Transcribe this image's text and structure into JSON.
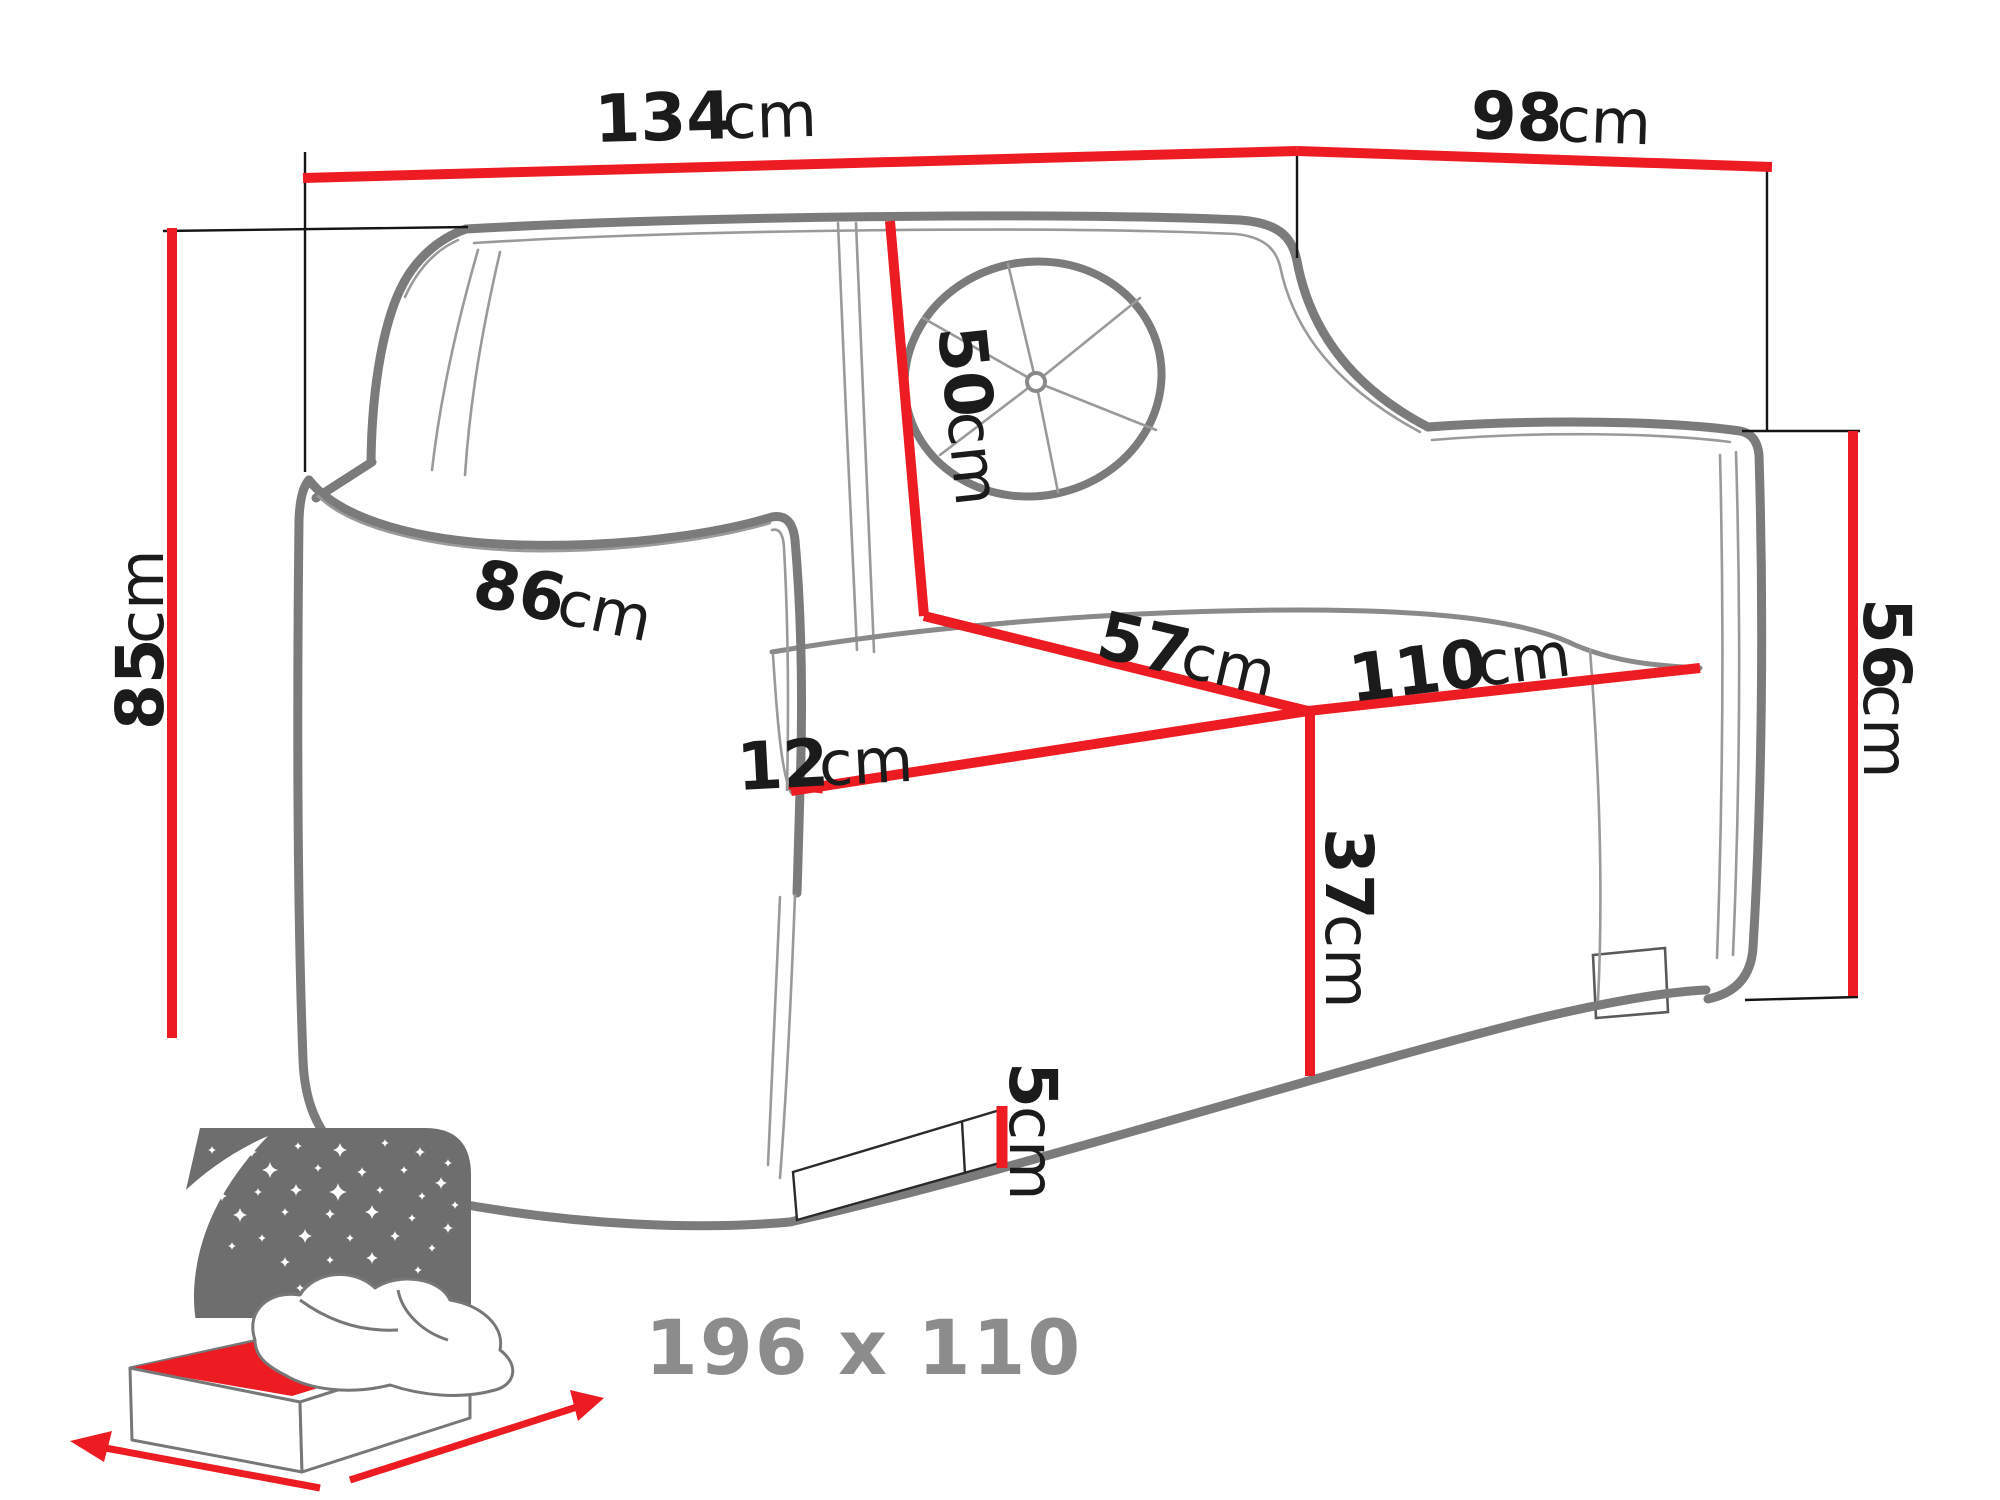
{
  "dims": {
    "w134": {
      "v": "134",
      "u": "cm"
    },
    "d98": {
      "v": "98",
      "u": "cm"
    },
    "h85": {
      "v": "85",
      "u": "cm"
    },
    "back50": {
      "v": "50",
      "u": "cm"
    },
    "arm86": {
      "v": "86",
      "u": "cm"
    },
    "arm12": {
      "v": "12",
      "u": "cm"
    },
    "seat57": {
      "v": "57",
      "u": "cm"
    },
    "seat110": {
      "v": "110",
      "u": "cm"
    },
    "front37": {
      "v": "37",
      "u": "cm"
    },
    "side56": {
      "v": "56",
      "u": "cm"
    },
    "leg5": {
      "v": "5",
      "u": "cm"
    }
  },
  "sleeping": {
    "size": "196 x 110"
  },
  "colors": {
    "dimension_red": "#ed1b22",
    "outline_gray": "#7b7b7b",
    "text_black": "#1b1b1b",
    "icon_gray": "#6e6e6e",
    "label_gray": "#8c8c8c"
  },
  "icon": {
    "name": "sleeping-function-icon",
    "stars": [
      [
        252,
        1152,
        5
      ],
      [
        298,
        1146,
        4
      ],
      [
        340,
        1150,
        7
      ],
      [
        385,
        1143,
        4
      ],
      [
        420,
        1152,
        5
      ],
      [
        448,
        1163,
        4
      ],
      [
        230,
        1172,
        4
      ],
      [
        270,
        1170,
        8
      ],
      [
        318,
        1168,
        4
      ],
      [
        362,
        1172,
        5
      ],
      [
        404,
        1170,
        4
      ],
      [
        441,
        1183,
        6
      ],
      [
        222,
        1196,
        5
      ],
      [
        258,
        1192,
        4
      ],
      [
        296,
        1190,
        6
      ],
      [
        338,
        1192,
        9
      ],
      [
        380,
        1190,
        4
      ],
      [
        422,
        1196,
        4
      ],
      [
        455,
        1205,
        4
      ],
      [
        240,
        1215,
        7
      ],
      [
        285,
        1212,
        4
      ],
      [
        330,
        1214,
        5
      ],
      [
        372,
        1212,
        7
      ],
      [
        412,
        1218,
        4
      ],
      [
        448,
        1228,
        5
      ],
      [
        262,
        1238,
        4
      ],
      [
        305,
        1236,
        7
      ],
      [
        350,
        1238,
        4
      ],
      [
        395,
        1236,
        5
      ],
      [
        432,
        1248,
        4
      ],
      [
        285,
        1262,
        5
      ],
      [
        330,
        1260,
        4
      ],
      [
        372,
        1258,
        6
      ],
      [
        418,
        1270,
        4
      ],
      [
        300,
        1288,
        4
      ],
      [
        345,
        1284,
        5
      ],
      [
        395,
        1282,
        4
      ],
      [
        440,
        1292,
        5
      ],
      [
        232,
        1246,
        4
      ],
      [
        212,
        1150,
        4
      ]
    ]
  }
}
